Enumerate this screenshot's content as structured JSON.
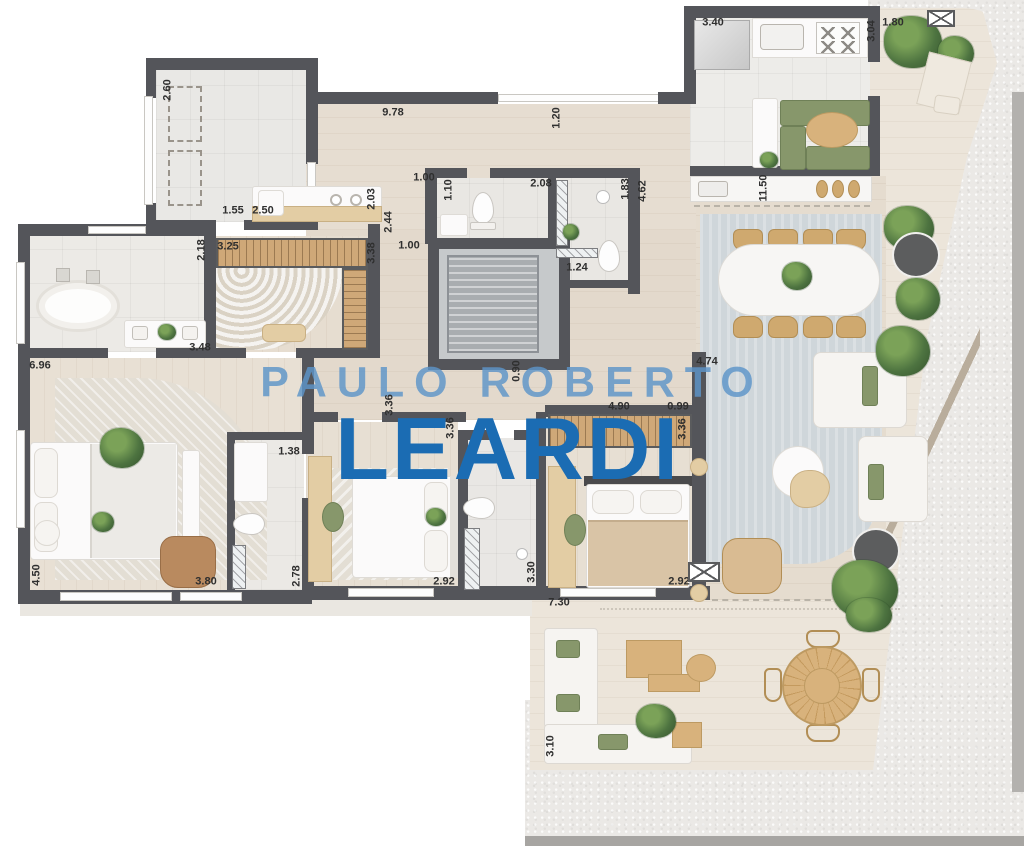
{
  "watermark": {
    "line1": "PAULO ROBERTO",
    "line2": "LEARDI"
  },
  "colors": {
    "wall": "#54555a",
    "label": "#2f2f2f",
    "watermark_top": "#5d95c9",
    "watermark_bottom": "#1b6cb3"
  },
  "labels": [
    {
      "text": "2.60",
      "x": 168,
      "y": 90,
      "v": true
    },
    {
      "text": "9.78",
      "x": 393,
      "y": 113,
      "v": false
    },
    {
      "text": "1.20",
      "x": 557,
      "y": 118,
      "v": true
    },
    {
      "text": "3.40",
      "x": 713,
      "y": 23,
      "v": false
    },
    {
      "text": "3.04",
      "x": 872,
      "y": 31,
      "v": true
    },
    {
      "text": "1.80",
      "x": 893,
      "y": 23,
      "v": false
    },
    {
      "text": "1.55",
      "x": 233,
      "y": 211,
      "v": false
    },
    {
      "text": "2.50",
      "x": 263,
      "y": 211,
      "v": false
    },
    {
      "text": "2.03",
      "x": 372,
      "y": 199,
      "v": true
    },
    {
      "text": "2.44",
      "x": 389,
      "y": 222,
      "v": true
    },
    {
      "text": "11.50",
      "x": 764,
      "y": 188,
      "v": true
    },
    {
      "text": "1.00",
      "x": 424,
      "y": 178,
      "v": false
    },
    {
      "text": "1.10",
      "x": 449,
      "y": 190,
      "v": true
    },
    {
      "text": "2.08",
      "x": 541,
      "y": 184,
      "v": false
    },
    {
      "text": "1.83",
      "x": 626,
      "y": 189,
      "v": true
    },
    {
      "text": "4.62",
      "x": 643,
      "y": 191,
      "v": true
    },
    {
      "text": "1.00",
      "x": 409,
      "y": 246,
      "v": false
    },
    {
      "text": "1.24",
      "x": 577,
      "y": 268,
      "v": false
    },
    {
      "text": "2.18",
      "x": 202,
      "y": 250,
      "v": true
    },
    {
      "text": "3.25",
      "x": 228,
      "y": 247,
      "v": false
    },
    {
      "text": "3.38",
      "x": 372,
      "y": 253,
      "v": true
    },
    {
      "text": "3.48",
      "x": 200,
      "y": 348,
      "v": false
    },
    {
      "text": "6.96",
      "x": 40,
      "y": 366,
      "v": false
    },
    {
      "text": "0.90",
      "x": 517,
      "y": 371,
      "v": true
    },
    {
      "text": "4.74",
      "x": 707,
      "y": 362,
      "v": false
    },
    {
      "text": "4.90",
      "x": 619,
      "y": 407,
      "v": false
    },
    {
      "text": "0.99",
      "x": 678,
      "y": 407,
      "v": false
    },
    {
      "text": "3.36",
      "x": 390,
      "y": 405,
      "v": true
    },
    {
      "text": "3.36",
      "x": 451,
      "y": 428,
      "v": true
    },
    {
      "text": "3.36",
      "x": 683,
      "y": 429,
      "v": true
    },
    {
      "text": "1.38",
      "x": 289,
      "y": 452,
      "v": false
    },
    {
      "text": "4.50",
      "x": 37,
      "y": 575,
      "v": true
    },
    {
      "text": "3.80",
      "x": 206,
      "y": 582,
      "v": false
    },
    {
      "text": "2.78",
      "x": 297,
      "y": 576,
      "v": true
    },
    {
      "text": "2.92",
      "x": 444,
      "y": 582,
      "v": false
    },
    {
      "text": "3.30",
      "x": 532,
      "y": 572,
      "v": true
    },
    {
      "text": "2.92",
      "x": 679,
      "y": 582,
      "v": false
    },
    {
      "text": "7.30",
      "x": 559,
      "y": 603,
      "v": false
    },
    {
      "text": "3.10",
      "x": 551,
      "y": 746,
      "v": true
    }
  ],
  "symbols": [
    {
      "name": "vent-symbol",
      "x": 927,
      "y": 10,
      "w": 28,
      "h": 17
    },
    {
      "name": "vent-symbol",
      "x": 688,
      "y": 562,
      "w": 32,
      "h": 20
    }
  ]
}
